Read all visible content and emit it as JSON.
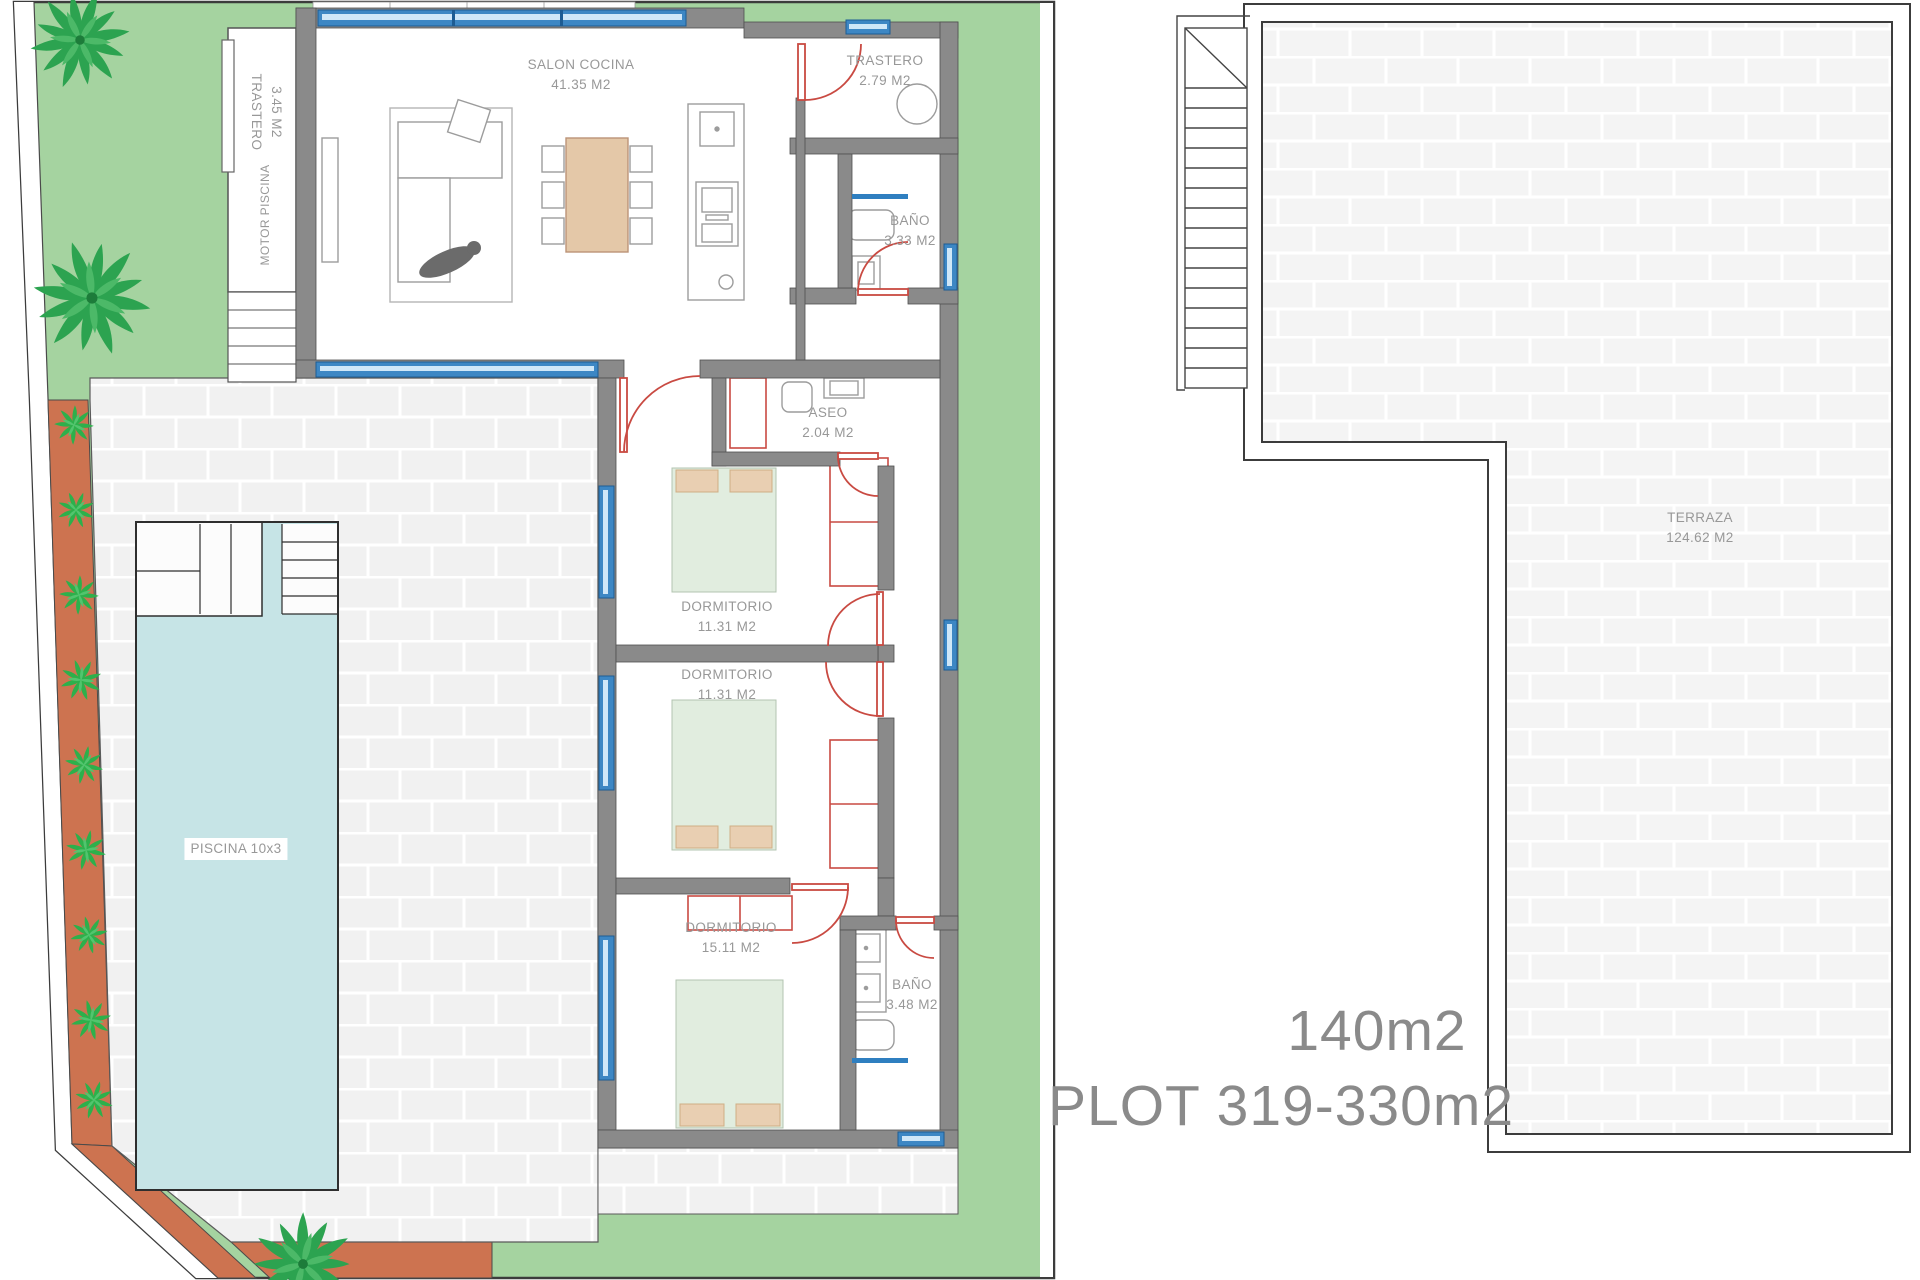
{
  "title": "Villa floor plan with pool and roof terrace",
  "rooms": {
    "salon": {
      "name": "SALON COCINA",
      "area": "41.35 M2"
    },
    "trastero_left": {
      "name": "TRASTERO",
      "area": "3.45 M2"
    },
    "motor": {
      "name": "MOTOR PISCINA"
    },
    "trastero_top": {
      "name": "TRASTERO",
      "area": "2.79 M2"
    },
    "bano_top": {
      "name": "BAÑO",
      "area": "3.33 M2"
    },
    "aseo": {
      "name": "ASEO",
      "area": "2.04 M2"
    },
    "dorm1": {
      "name": "DORMITORIO",
      "area": "11.31 M2"
    },
    "dorm2": {
      "name": "DORMITORIO",
      "area": "11.31 M2"
    },
    "dorm3": {
      "name": "DORMITORIO",
      "area": "15.11 M2"
    },
    "bano_bottom": {
      "name": "BAÑO",
      "area": "3.48 M2"
    }
  },
  "pool": {
    "label": "PISCINA 10x3"
  },
  "terrace": {
    "name": "TERRAZA",
    "area": "124.62 M2"
  },
  "summary": {
    "built_area": "140m2",
    "plot": "PLOT 319-330m2"
  },
  "icons": {
    "palm": "palm-tree-icon",
    "plant": "aloe-plant-icon",
    "person": "person-figure-icon",
    "stairs": "stairs-icon"
  },
  "colors": {
    "grass": "#a5d3a0",
    "terracotta": "#cd7350",
    "pool_water": "#c6e4e6",
    "wall": "#8a8a8a",
    "window_blue": "#3d87c4",
    "door_red": "#c94a42",
    "bed_green": "#e1eddf",
    "pillow_tan": "#e9cfb2",
    "table_tan": "#e4c8a8",
    "label_text": "#989898",
    "summary_text": "#8a8a8a"
  }
}
